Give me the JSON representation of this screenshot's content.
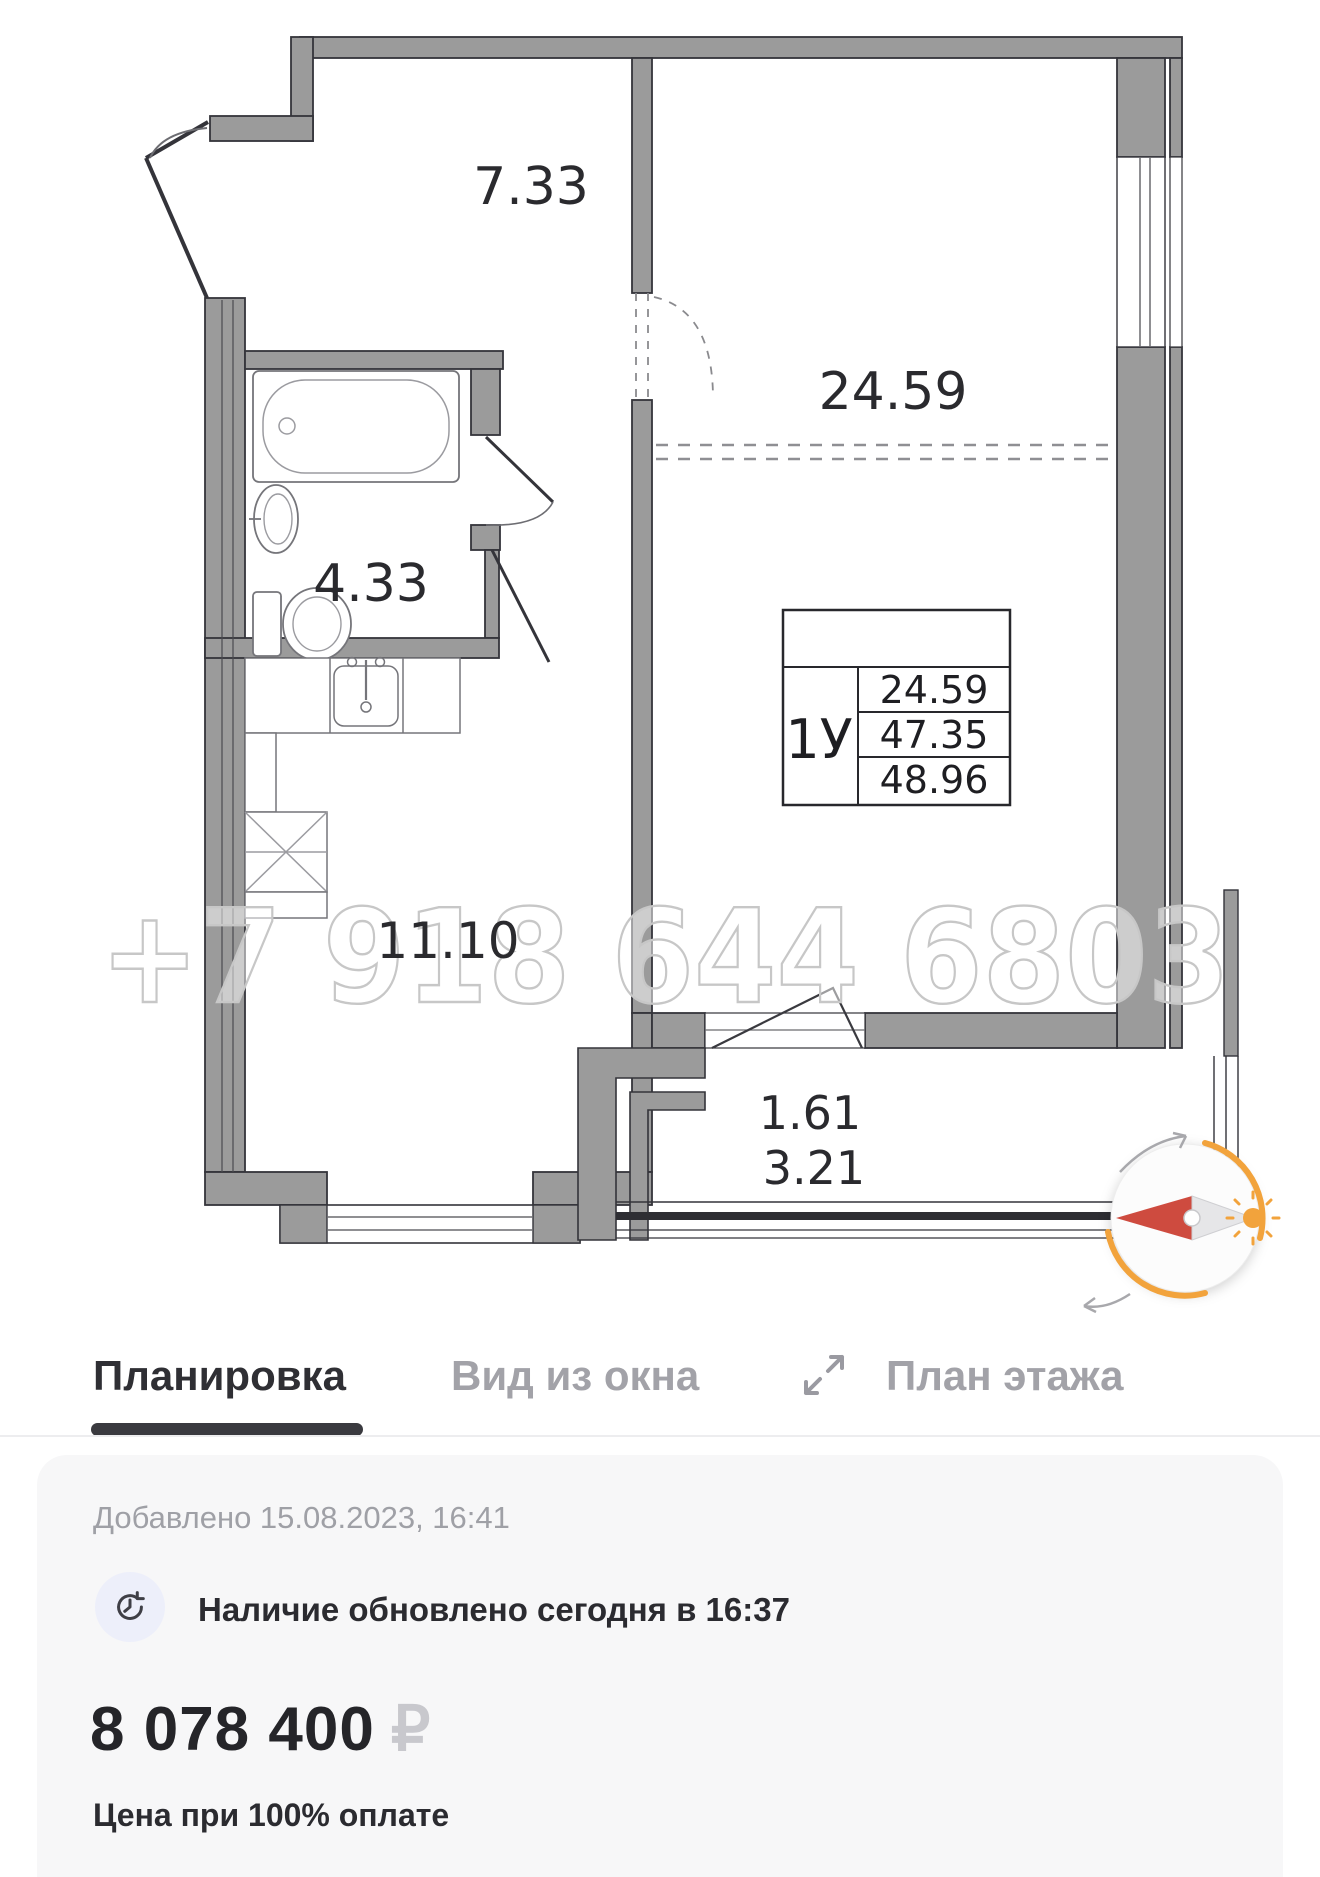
{
  "floor_plan": {
    "watermark": "+7 918 644 6803",
    "labels": {
      "hallway": "7.33",
      "bathroom": "4.33",
      "living_room": "24.59",
      "kitchen": "11.10",
      "balcony_reduced": "1.61",
      "balcony_full": "3.21"
    },
    "legend": {
      "apartment_type": "1У",
      "living_area": "24.59",
      "area_no_balcony": "47.35",
      "total_area": "48.96"
    },
    "icons": {
      "compass": "compass-needle-with-sun",
      "sun": "sun-icon"
    }
  },
  "tabs": [
    {
      "label": "Планировка",
      "active": true
    },
    {
      "label": "Вид из окна",
      "active": false
    },
    {
      "label": "План этажа",
      "active": false,
      "icon": "expand-arrows"
    }
  ],
  "info_card": {
    "added_text": "Добавлено 15.08.2023, 16:41",
    "availability_text": "Наличие обновлено сегодня в 16:37",
    "availability_icon": "clock-history",
    "price": "8 078 400",
    "currency": "₽",
    "price_note": "Цена при 100% оплате"
  },
  "colors": {
    "wall_gray": "#9B9B9B",
    "wall_outline": "#34343A",
    "accent_orange": "#F2A33C",
    "needle_red": "#CE4B3F",
    "tab_active": "#2F2F34",
    "tab_inactive": "#A2A2A8",
    "watermark_gray": "#C7C7C7"
  }
}
